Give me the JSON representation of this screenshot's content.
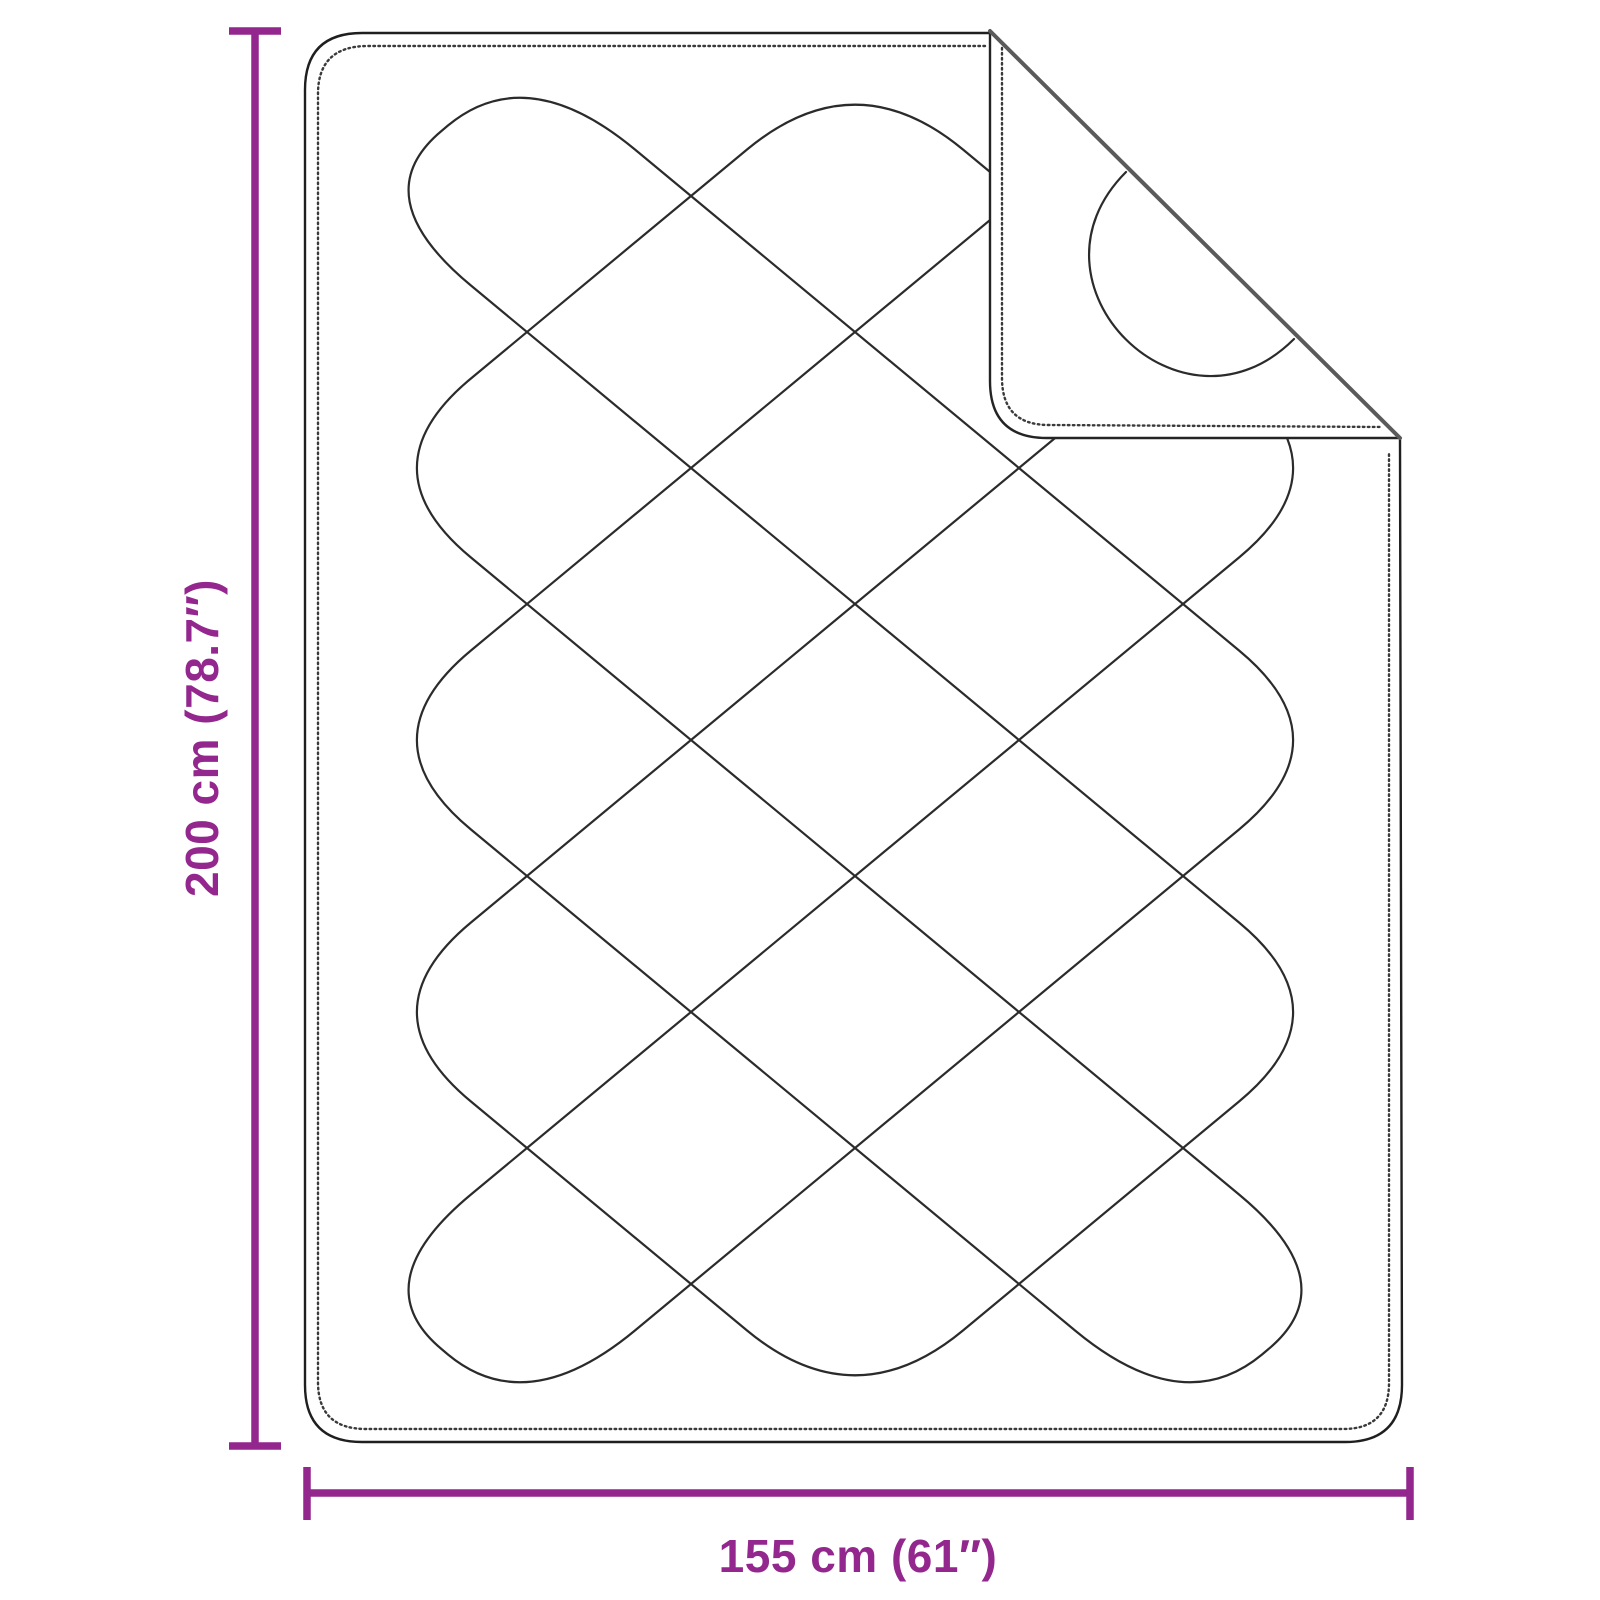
{
  "diagram": {
    "kind": "product-dimension-diagram",
    "subject": "quilted duvet / weighted blanket with folded-back top corner",
    "height_dimension": {
      "label": "200 cm (78.7″)",
      "value_cm": 200,
      "value_inch": 78.7
    },
    "width_dimension": {
      "label": "155 cm (61″)",
      "value_cm": 155,
      "value_inch": 61
    }
  },
  "colors": {
    "dimension_accent": "#93278E",
    "drawing_outline": "#1f1f1f",
    "quilt_line": "#2b2b2b",
    "stitch_line": "#3a3a3a",
    "fold_crease": "#5a5a5a",
    "background": "#ffffff"
  }
}
